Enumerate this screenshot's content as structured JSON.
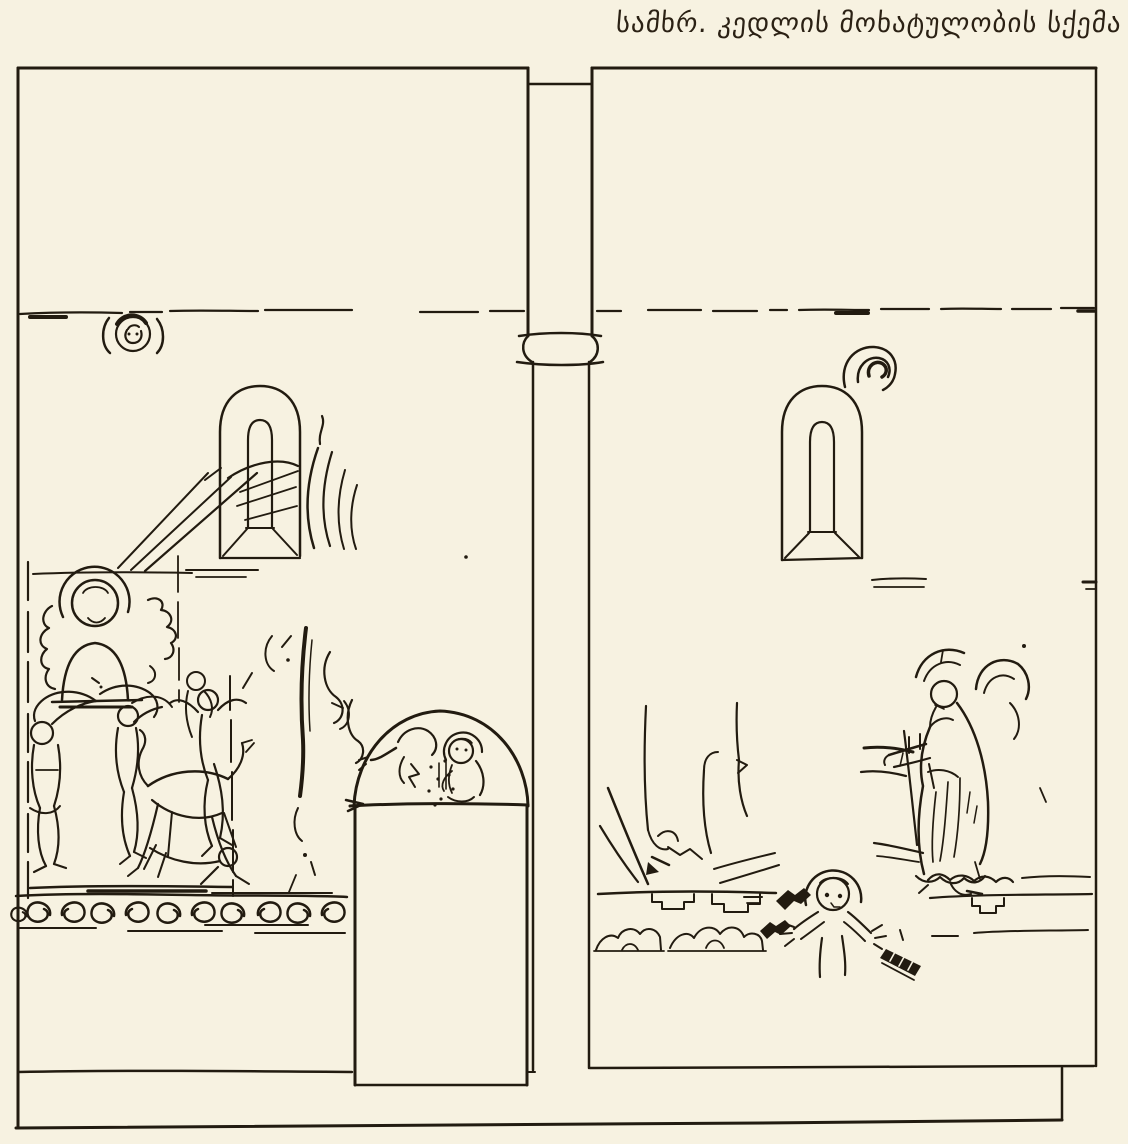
{
  "page": {
    "background_color": "#f7f2e1",
    "ink_color": "#221b10",
    "caption_color": "#2b2114"
  },
  "caption": {
    "text": "სამხრ. კედლის მოხატულობის სქემა"
  },
  "drawing": {
    "parts": [
      "left-wall-bay",
      "pilaster",
      "right-wall-bay",
      "left-arched-window",
      "right-arched-window",
      "medallion-ornament",
      "curl-ornament",
      "cornice-dashed-line",
      "left-upper-fresco-scene",
      "left-lower-fresco-scene",
      "scroll-ornament-band",
      "fresco-fragments",
      "doorway-with-lunette-fresco",
      "right-fresco-fragments",
      "cross-frame-fresco",
      "standing-figure-fresco",
      "orant-figure-fresco",
      "register-lines",
      "plinth-band"
    ]
  }
}
